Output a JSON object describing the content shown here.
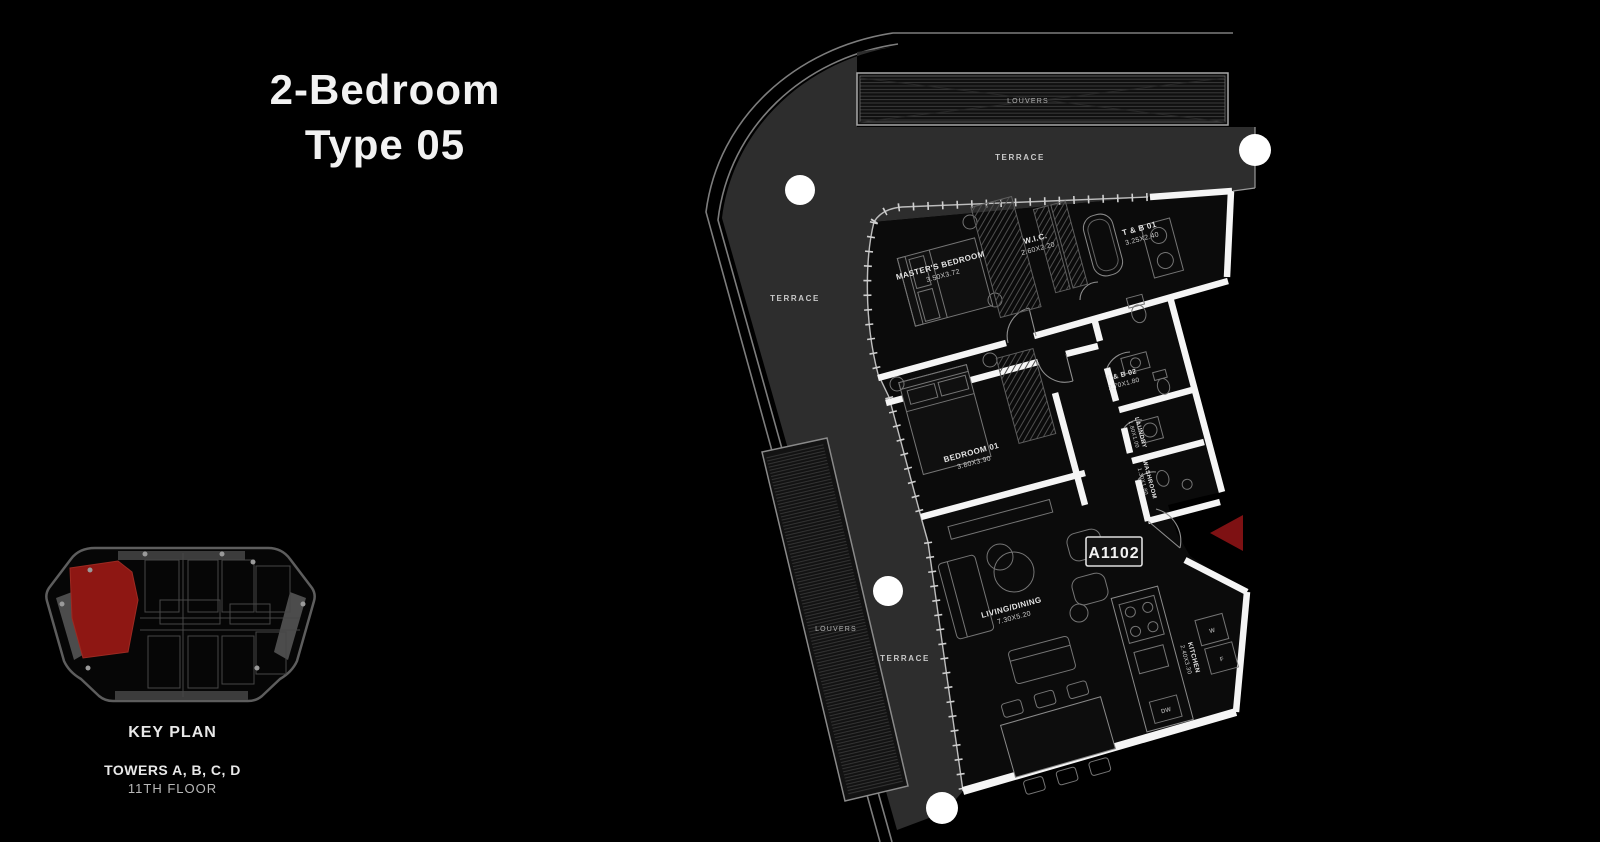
{
  "title": {
    "line1": "2-Bedroom",
    "line2": "Type 05"
  },
  "key_plan": {
    "caption": "KEY PLAN",
    "towers": "TOWERS A, B, C, D",
    "floor": "11TH FLOOR"
  },
  "unit": {
    "number": "A1102"
  },
  "rooms": [
    {
      "name": "MASTER'S BEDROOM",
      "dims": "3.50X3.72"
    },
    {
      "name": "W.I.C.",
      "dims": "2.60X2.20"
    },
    {
      "name": "T & B 01",
      "dims": "3.25X2.40"
    },
    {
      "name": "BEDROOM 01",
      "dims": "3.80X3.90"
    },
    {
      "name": "T & B 02",
      "dims": "2.70X1.80"
    },
    {
      "name": "LAUNDRY",
      "dims": "1.80X1.00"
    },
    {
      "name": "WASHROOM",
      "dims": "1.30X1.80"
    },
    {
      "name": "LIVING/DINING",
      "dims": "7.30X5.20"
    },
    {
      "name": "KITCHEN",
      "dims": "2.40X3.30"
    }
  ],
  "annotations": {
    "terrace": "TERRACE",
    "louvers": "LOUVERS",
    "dishwasher": "DW",
    "washer": "W",
    "fridge": "F"
  },
  "colors": {
    "background": "#000000",
    "terrace_fill": "#2d2d2d",
    "wall_white": "#f5f5f5",
    "key_unit_red": "#8e1713",
    "entry_arrow_red": "#7e1113",
    "line_gray": "#8a8a8a"
  }
}
